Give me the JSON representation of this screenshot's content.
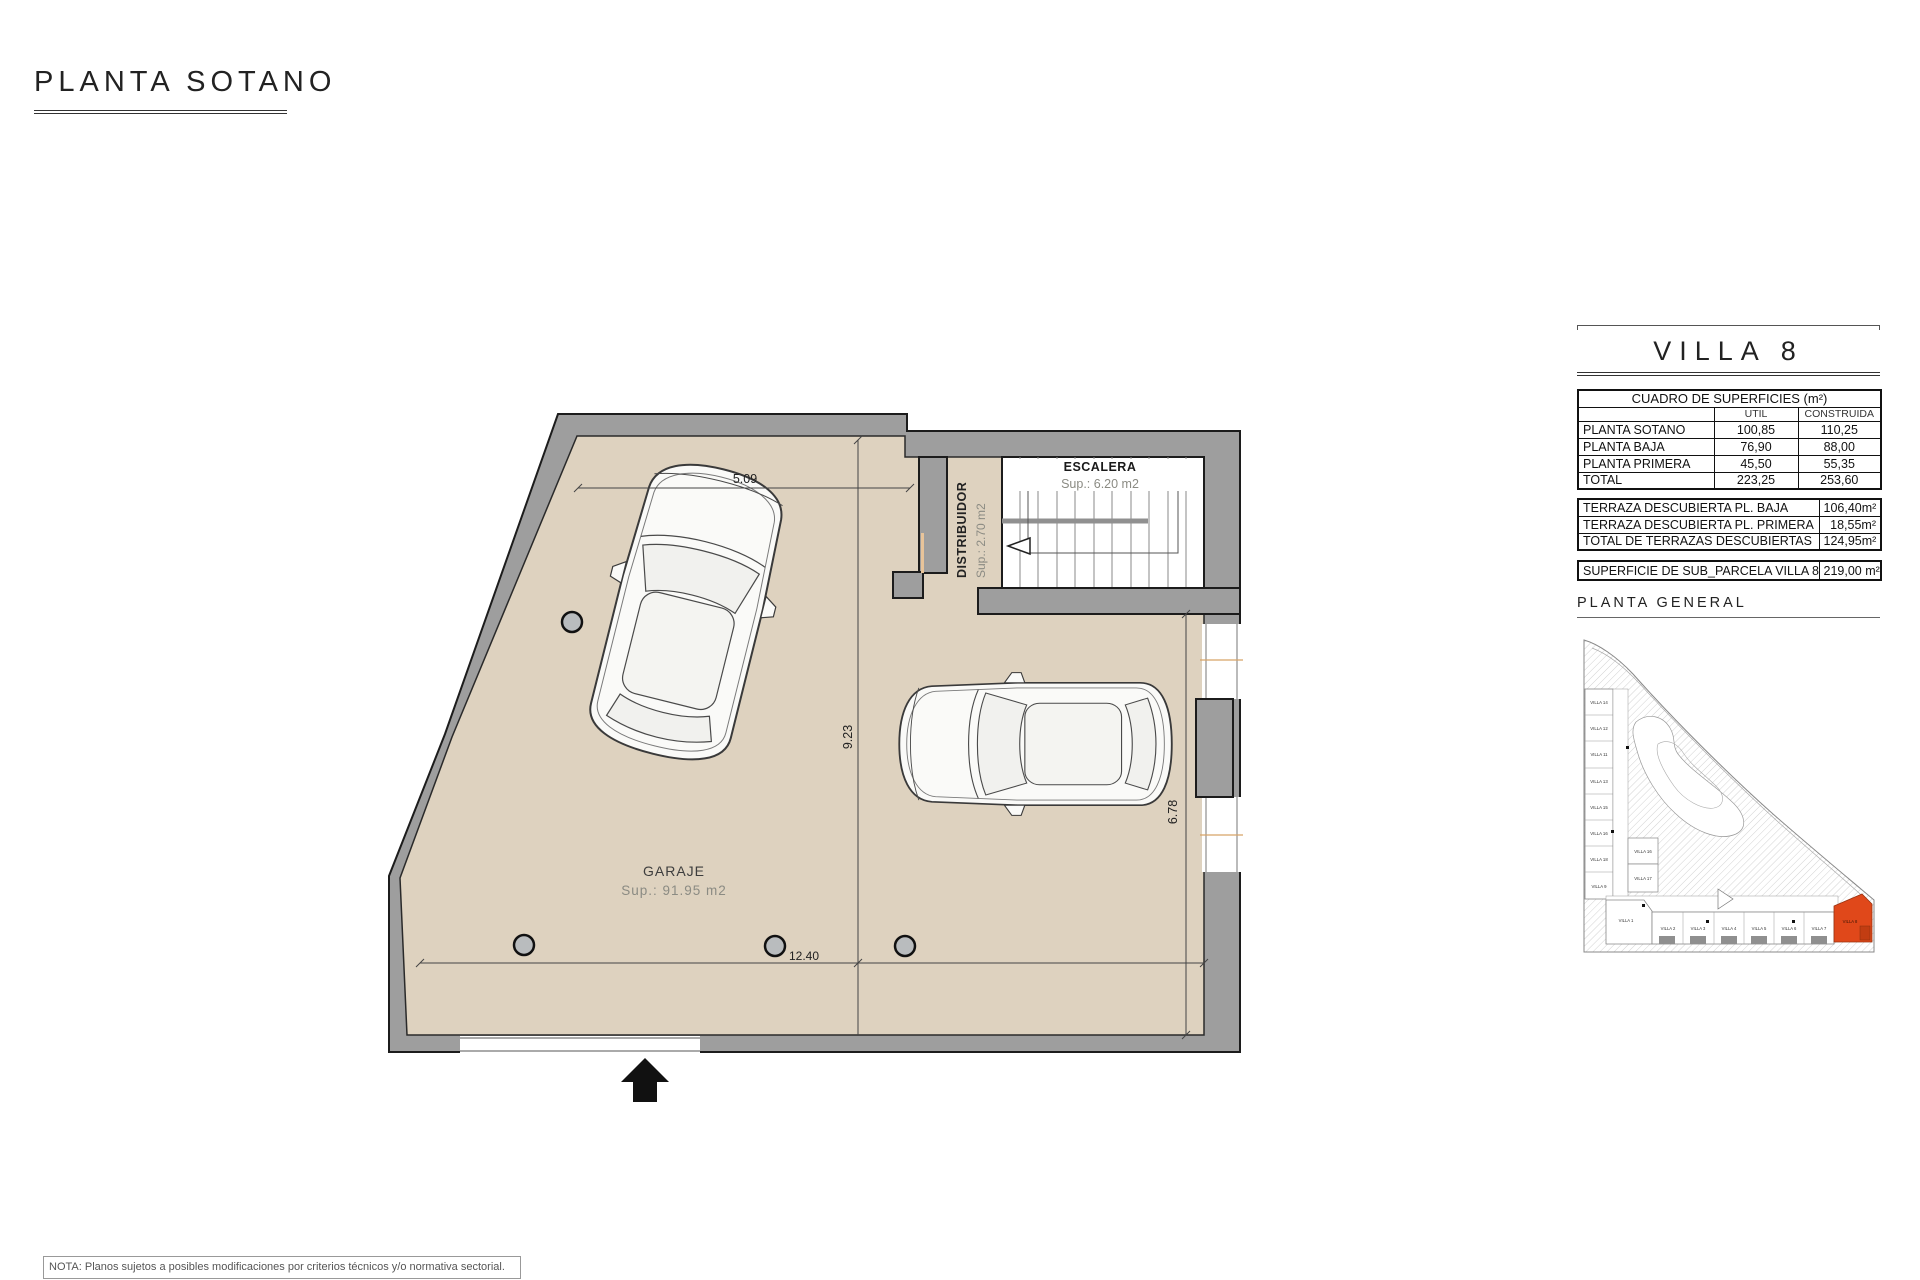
{
  "page_title": "PLANTA SOTANO",
  "floor_plan": {
    "garaje_label": "GARAJE",
    "garaje_sup": "Sup.: 91.95  m2",
    "escalera_label": "ESCALERA",
    "escalera_sup": "Sup.: 6.20   m2",
    "distribuidor_label": "DISTRIBUIDOR",
    "distribuidor_sup": "Sup.: 2.70   m2",
    "dim_top": "5.09",
    "dim_left": "9.23",
    "dim_bottom": "12.40",
    "dim_right": "6.78"
  },
  "panel": {
    "villa_title": "VILLA 8",
    "superficies": {
      "title": "CUADRO DE SUPERFICIES (m²)",
      "col_util": "UTIL",
      "col_construida": "CONSTRUIDA",
      "rows": [
        {
          "name": "PLANTA SOTANO",
          "util": "100,85",
          "construida": "110,25"
        },
        {
          "name": "PLANTA BAJA",
          "util": "76,90",
          "construida": "88,00"
        },
        {
          "name": "PLANTA PRIMERA",
          "util": "45,50",
          "construida": "55,35"
        },
        {
          "name": "TOTAL",
          "util": "223,25",
          "construida": "253,60"
        }
      ]
    },
    "terrazas": {
      "rows": [
        {
          "name": "TERRAZA DESCUBIERTA PL. BAJA",
          "value": "106,40m²"
        },
        {
          "name": "TERRAZA DESCUBIERTA PL. PRIMERA",
          "value": "18,55m²"
        },
        {
          "name": "TOTAL DE TERRAZAS DESCUBIERTAS",
          "value": "124,95m²"
        }
      ]
    },
    "parcela": {
      "name": "SUPERFICIE DE SUB_PARCELA VILLA 8",
      "value": "219,00 m²"
    },
    "planta_general_title": "PLANTA  GENERAL"
  },
  "site_plan": {
    "left_villas": [
      "VILLA 14",
      "VILLA 12",
      "VILLA 11",
      "VILLA 13",
      "VILLA 15",
      "VILLA 16",
      "VILLA 18",
      "VILLA 9"
    ],
    "middle_villas": [
      "VILLA 16",
      "VILLA 17"
    ],
    "bottom_villas": [
      "VILLA 1",
      "VILLA 2",
      "VILLA 3",
      "VILLA 4",
      "VILLA 5",
      "VILLA 6",
      "VILLA 7"
    ],
    "highlight_villa": "VILLA 8",
    "highlight_color": "#E0481A"
  },
  "note": "NOTA: Planos sujetos a posibles modificaciones por criterios técnicos y/o normativa sectorial.",
  "colors": {
    "floor": "#DED2BF",
    "wall": "#9E9E9E"
  }
}
